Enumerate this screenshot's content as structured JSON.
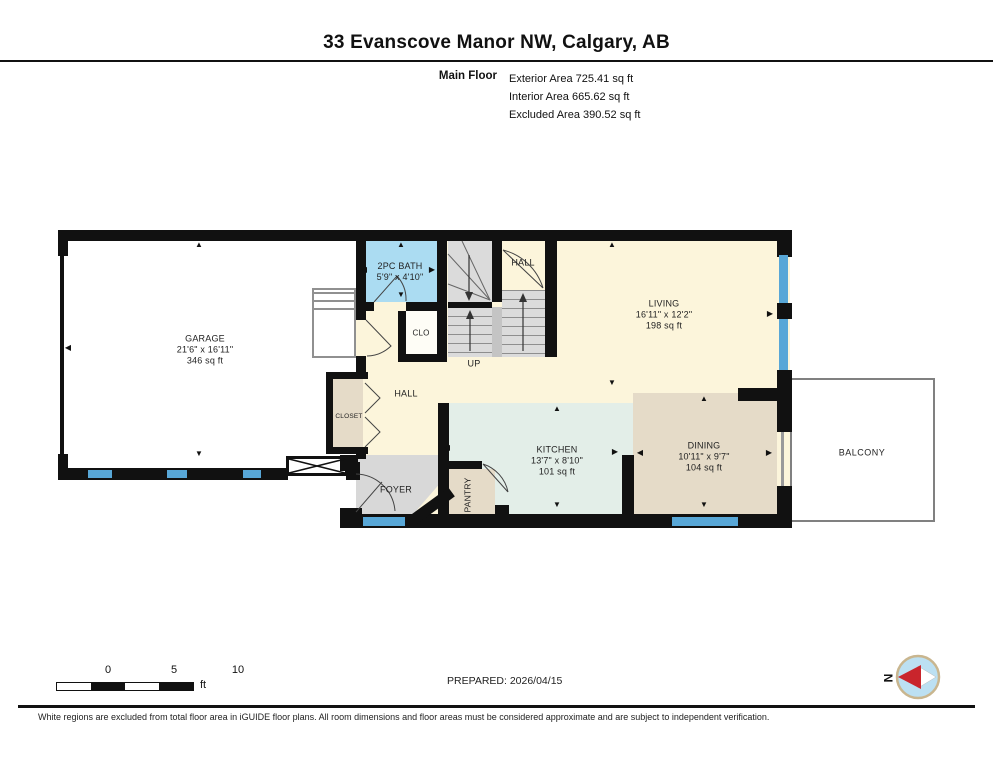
{
  "header": {
    "title": "33 Evanscove Manor NW, Calgary, AB",
    "floor_label": "Main Floor",
    "area_lines": [
      "Exterior Area 725.41 sq ft",
      "Interior Area 665.62 sq ft",
      "Excluded Area 390.52 sq ft"
    ]
  },
  "plan": {
    "rooms": {
      "garage": {
        "name": "GARAGE",
        "dims": "21'6\" x 16'11\"",
        "area": "346 sq ft"
      },
      "bath": {
        "name": "2PC BATH",
        "dims": "5'9\" x 4'10\""
      },
      "hall_upper": {
        "name": "HALL"
      },
      "stairs_up": {
        "name": "UP"
      },
      "clo": {
        "name": "CLO"
      },
      "hall_main": {
        "name": "HALL"
      },
      "closet": {
        "name": "CLOSET"
      },
      "foyer": {
        "name": "FOYER"
      },
      "pantry": {
        "name": "PANTRY"
      },
      "living": {
        "name": "LIVING",
        "dims": "16'11\" x 12'2\"",
        "area": "198 sq ft"
      },
      "kitchen": {
        "name": "KITCHEN",
        "dims": "13'7\" x 8'10\"",
        "area": "101 sq ft"
      },
      "dining": {
        "name": "DINING",
        "dims": "10'11\" x 9'7\"",
        "area": "104 sq ft"
      },
      "balcony": {
        "name": "BALCONY"
      }
    }
  },
  "scale_bar": {
    "ticks": [
      "0",
      "5",
      "10"
    ],
    "unit": "ft"
  },
  "prepared_label": "PREPARED: 2026/04/15",
  "compass": {
    "letter": "N"
  },
  "footer": {
    "disclaimer": "White regions are excluded from total floor area in iGUIDE floor plans. All room dimensions and floor areas must be considered approximate and are subject to independent verification."
  },
  "colors": {
    "wall": "#111111",
    "window_blue": "#58A7D7",
    "bath_blue": "#ABDCF2",
    "floor_cream": "#FCF5DB",
    "kitchen_mint": "#E3EEE8",
    "tan": "#E5DBC8",
    "foyer_gray": "#D8D8D8",
    "stairs_gray": "#DBDBDB",
    "compass_red": "#C9252C"
  }
}
